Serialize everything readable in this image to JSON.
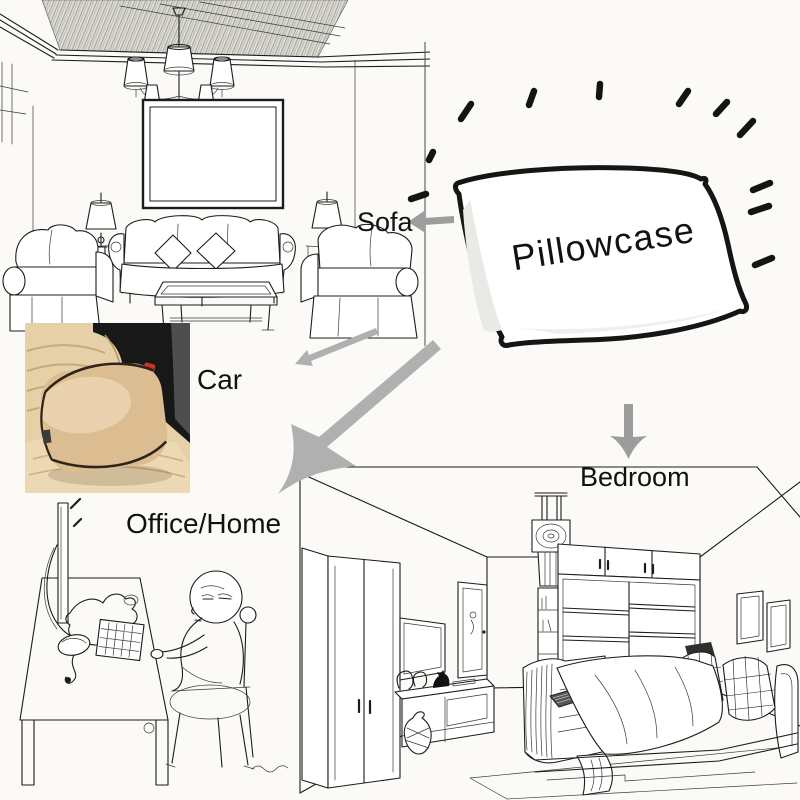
{
  "labels": {
    "pillowcase": "Pillowcase",
    "sofa": "Sofa",
    "car": "Car",
    "office_home": "Office/Home",
    "bedroom": "Bedroom"
  },
  "scenes": {
    "living_room": "living-room-line-sketch",
    "car_seat": "car-seat-cushion-photo",
    "office": "office-desk-cartoon-sketch",
    "bedroom": "bedroom-line-sketch",
    "pillow": "pillowcase-drawing-with-rays"
  },
  "colors": {
    "background": "#fbfaf7",
    "ink": "#1c1c1c",
    "sketch_line": "#3a3a3a",
    "arrow_gray": "#9d9d9d",
    "arrow_gray_light": "#b0b0b0",
    "label_text": "#111111",
    "car_seat_beige": "#e6d0a8",
    "car_pillow_beige": "#dcbd92",
    "car_pillow_highlight": "#eed9b6",
    "car_interior_dark": "#181818",
    "car_buckle_red": "#c2372a"
  }
}
